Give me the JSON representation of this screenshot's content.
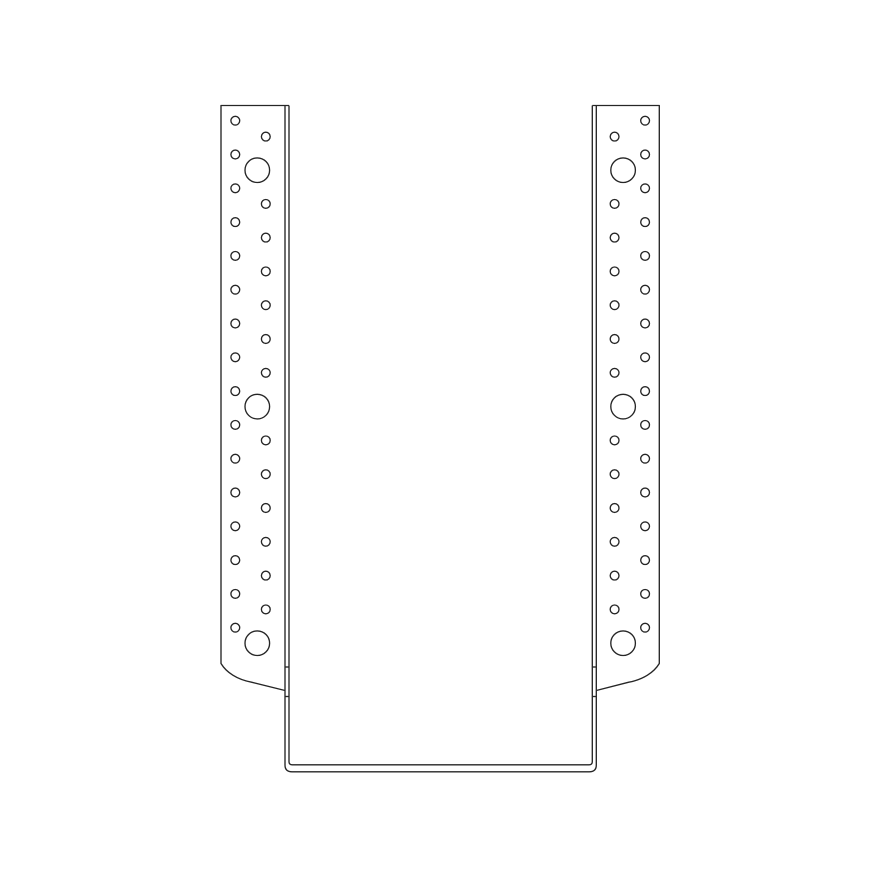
{
  "canvas": {
    "width": 880,
    "height": 880,
    "background": "#ffffff"
  },
  "style": {
    "stroke": "#262626",
    "stroke_width": 1.35,
    "hole_fill": "#ffffff"
  },
  "drawing": {
    "kind": "technical-line-drawing",
    "view": "front",
    "paths": [
      {
        "name": "left-flange-outline",
        "d": "M 289 105.5 L 221 105.5 L 221 663.5 C 226.5 672.5 237 679.5 251.5 682.2 L 285 690.5"
      },
      {
        "name": "right-flange-outline",
        "d": "M 592.3 105.5 L 659.3 105.5 L 659.3 663.5 C 653.8 672.5 643.3 679.5 628.8 682.2 L 596.3 690.5"
      },
      {
        "name": "stirrup-outer-edge",
        "d": "M 285 105.5 L 285 765 Q 285 771.8 292 771.8 L 589.3 771.8 Q 596.3 771.8 596.3 765 L 596.3 105.5"
      },
      {
        "name": "stirrup-inner-edge",
        "d": "M 289 105.5 L 289 761.6 Q 289 764.8 292.2 764.8 L 589.1 764.8 Q 592.3 764.8 592.3 761.6 L 592.3 105.5"
      },
      {
        "name": "left-seam-tick-upper",
        "d": "M 285 667 L 289 667"
      },
      {
        "name": "left-seam-tick-lower",
        "d": "M 285 696.5 L 289 696.5"
      },
      {
        "name": "right-seam-tick-upper",
        "d": "M 592.3 667 L 596.3 667"
      },
      {
        "name": "right-seam-tick-lower",
        "d": "M 592.3 696.5 L 596.3 696.5"
      }
    ],
    "hole_columns": [
      {
        "name": "left-flange-outer-nail-hole",
        "cx": 235.3,
        "r": 4.4,
        "cy": [
          120.7,
          154.5,
          188.3,
          222.1,
          255.9,
          289.7,
          323.5,
          357.3,
          391.1,
          424.9,
          458.7,
          492.5,
          526.3,
          560.1,
          593.9,
          627.7
        ]
      },
      {
        "name": "left-flange-inner-nail-hole",
        "cx": 265.8,
        "r": 4.4,
        "cy": [
          136.6,
          203.9,
          237.6,
          271.4,
          305.2,
          339.0,
          372.8,
          440.4,
          474.2,
          508.0,
          541.8,
          575.6,
          609.4
        ]
      },
      {
        "name": "left-flange-bolt-hole",
        "cx": 257.3,
        "r": 12.3,
        "cy": [
          170.2,
          406.6,
          643.2
        ]
      },
      {
        "name": "right-flange-outer-nail-hole",
        "cx": 645.1,
        "r": 4.4,
        "cy": [
          120.7,
          154.5,
          188.3,
          222.1,
          255.9,
          289.7,
          323.5,
          357.3,
          391.1,
          424.9,
          458.7,
          492.5,
          526.3,
          560.1,
          593.9,
          627.7
        ]
      },
      {
        "name": "right-flange-inner-nail-hole",
        "cx": 614.6,
        "r": 4.4,
        "cy": [
          136.6,
          203.9,
          237.6,
          271.4,
          305.2,
          339.0,
          372.8,
          440.4,
          474.2,
          508.0,
          541.8,
          575.6,
          609.4
        ]
      },
      {
        "name": "right-flange-bolt-hole",
        "cx": 623.1,
        "r": 12.3,
        "cy": [
          170.2,
          406.6,
          643.2
        ]
      }
    ]
  }
}
